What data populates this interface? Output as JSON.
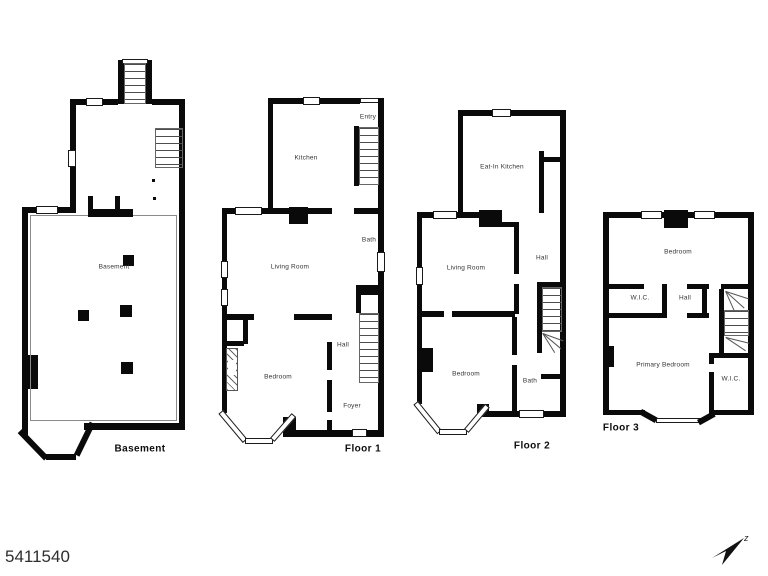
{
  "meta": {
    "listing_id": "5411540",
    "compass_label": "z",
    "background_color": "#ffffff",
    "wall_color": "#0a0a0a",
    "label_color": "#333333"
  },
  "floors": [
    {
      "name": "basement",
      "title": "Basement",
      "rooms": [
        {
          "label": "Basement"
        }
      ]
    },
    {
      "name": "floor-1",
      "title": "Floor 1",
      "rooms": [
        {
          "label": "Entry"
        },
        {
          "label": "Kitchen"
        },
        {
          "label": "Bath"
        },
        {
          "label": "Living Room"
        },
        {
          "label": "Hall"
        },
        {
          "label": "Bedroom"
        },
        {
          "label": "Foyer"
        }
      ]
    },
    {
      "name": "floor-2",
      "title": "Floor 2",
      "rooms": [
        {
          "label": "Eat-In Kitchen"
        },
        {
          "label": "Living Room"
        },
        {
          "label": "Hall"
        },
        {
          "label": "Bedroom"
        },
        {
          "label": "Bath"
        }
      ]
    },
    {
      "name": "floor-3",
      "title": "Floor 3",
      "rooms": [
        {
          "label": "Bedroom"
        },
        {
          "label": "W.I.C."
        },
        {
          "label": "Hall"
        },
        {
          "label": "Primary Bedroom"
        },
        {
          "label": "W.I.C."
        }
      ]
    }
  ]
}
